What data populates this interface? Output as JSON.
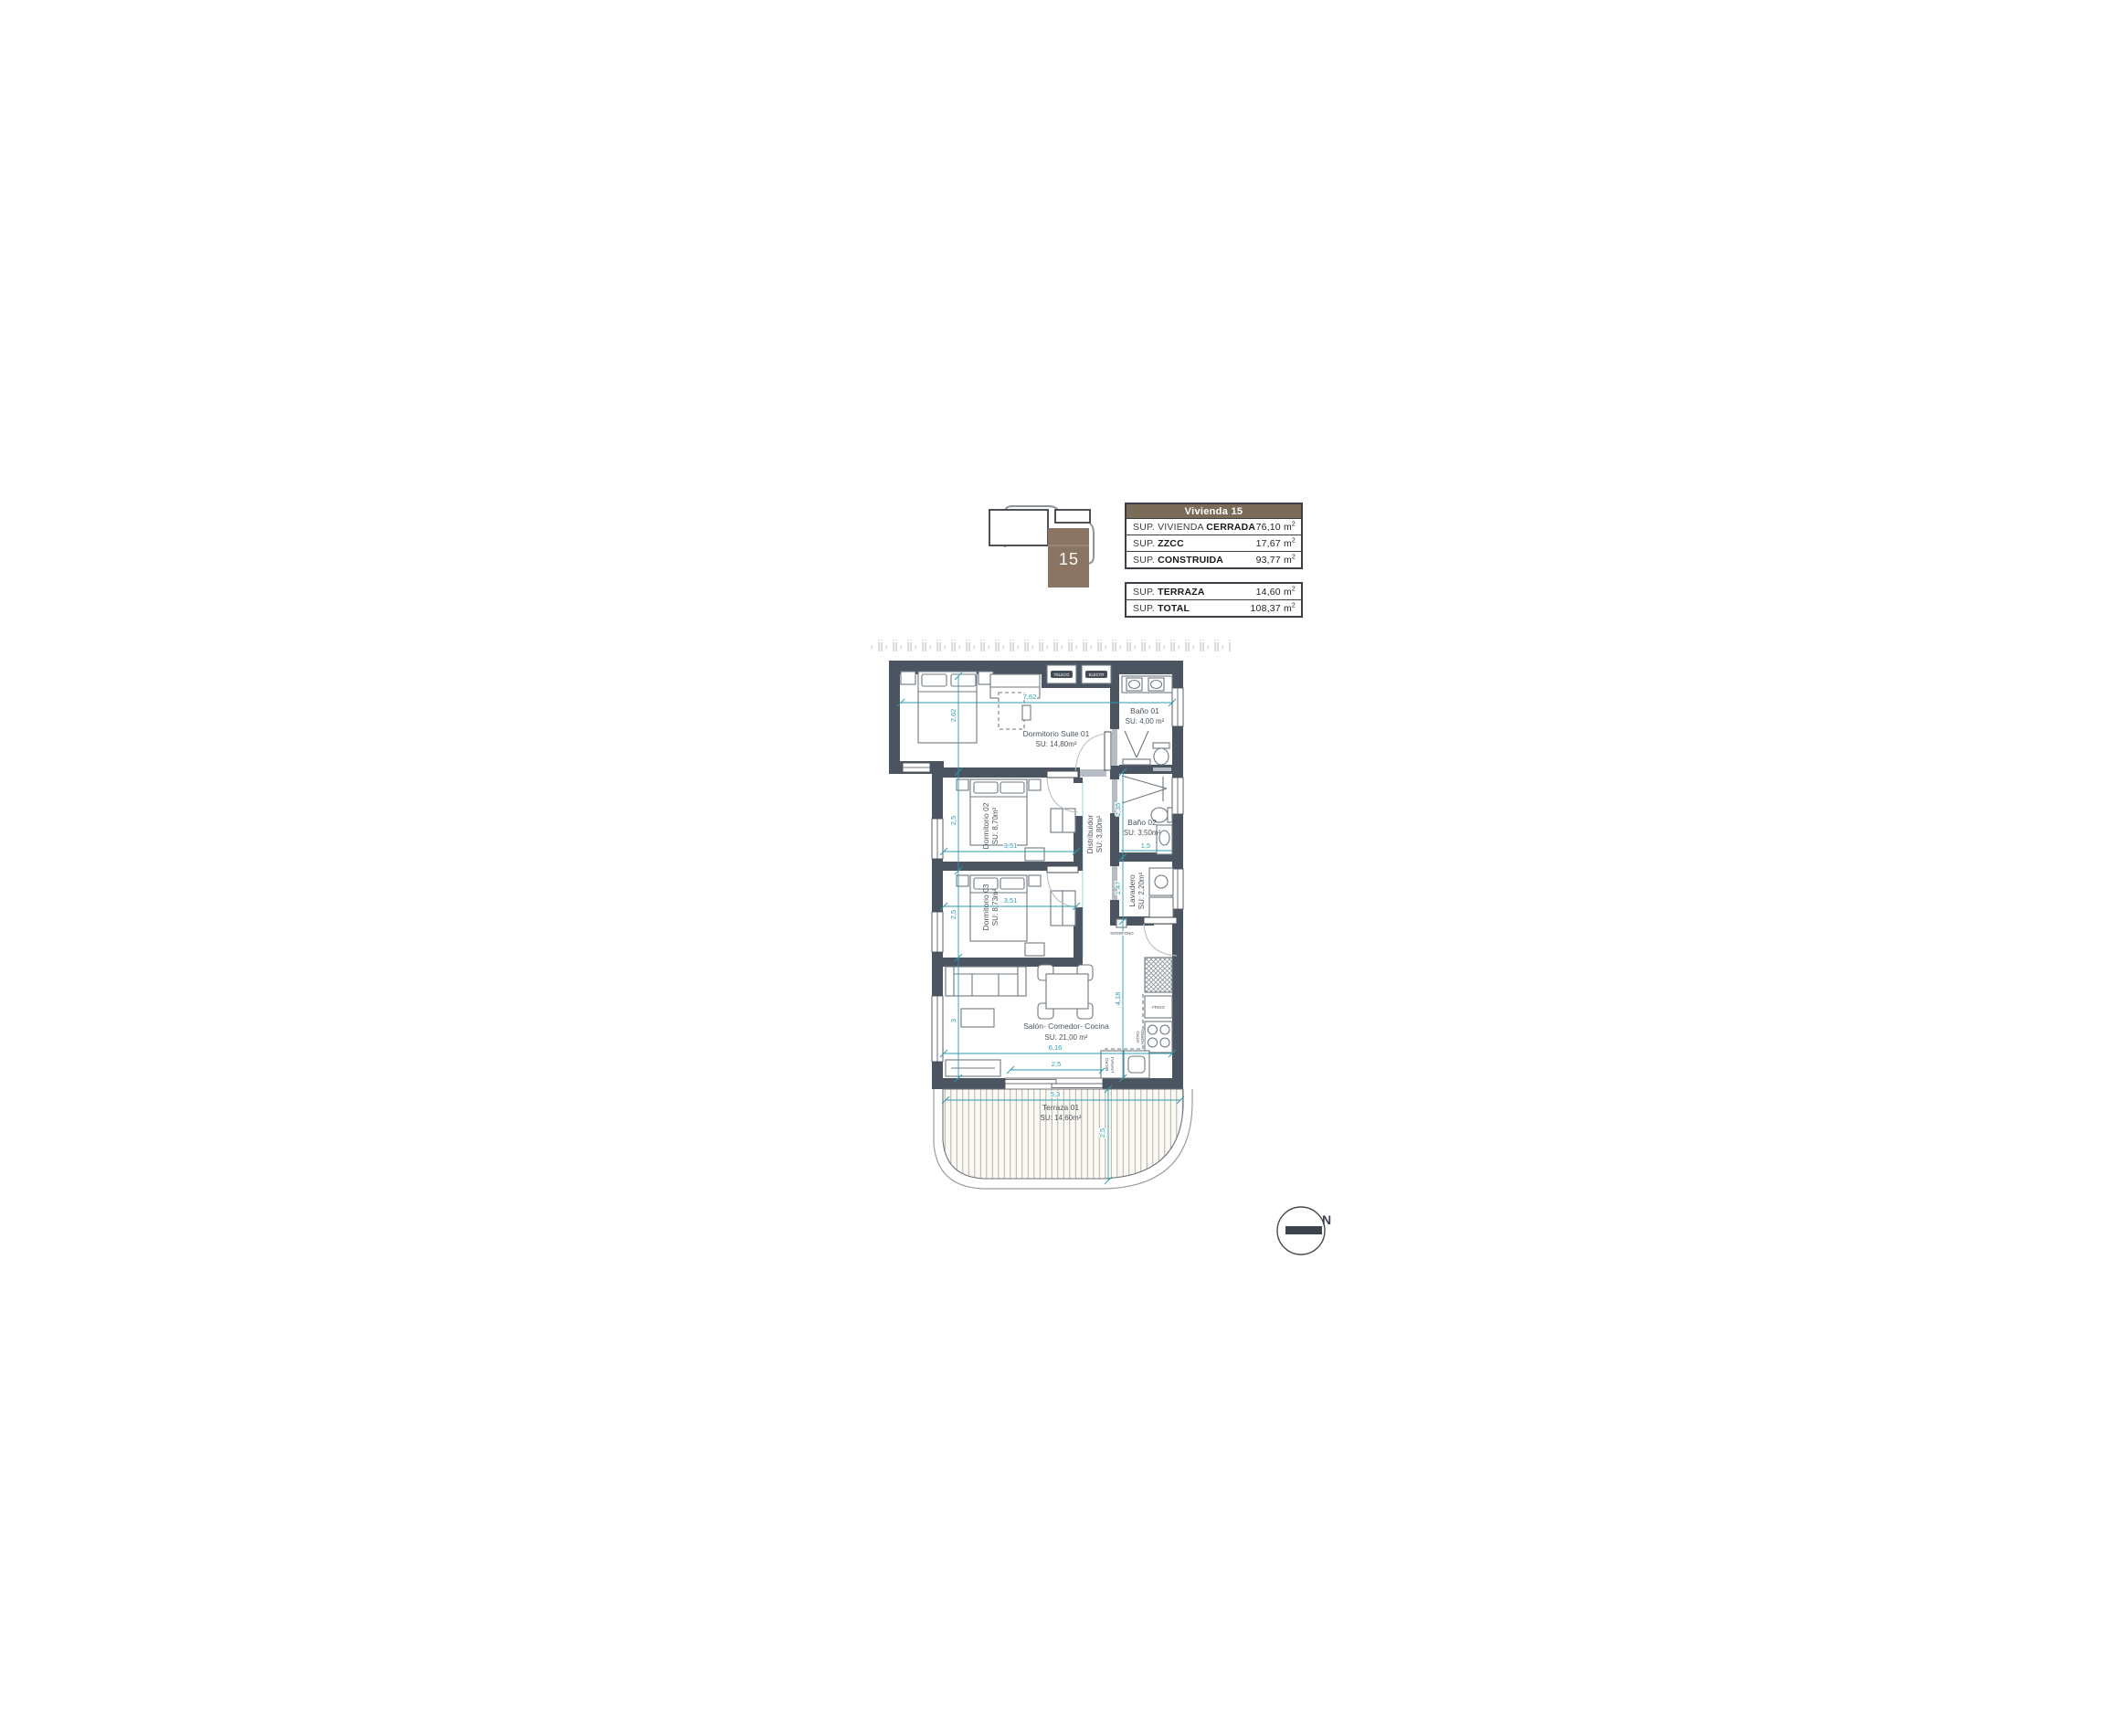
{
  "key_plan": {
    "unit_number": "15",
    "block_color": "#8a7464"
  },
  "summary_table": {
    "header": "Vivienda 15",
    "header_bg": "#7b6b59",
    "sections": [
      {
        "rows": [
          {
            "label": "SUP. VIVIENDA ",
            "label_bold": "CERRADA",
            "value": "76,10 m",
            "sup": "2"
          },
          {
            "label": "SUP. ",
            "label_bold": "ZZCC",
            "value": "17,67 m",
            "sup": "2"
          },
          {
            "label": "SUP. ",
            "label_bold": "CONSTRUIDA",
            "value": "93,77 m",
            "sup": "2"
          }
        ]
      },
      {
        "rows": [
          {
            "label": "SUP. ",
            "label_bold": "TERRAZA",
            "value": "14,60 m",
            "sup": "2"
          },
          {
            "label": "SUP. ",
            "label_bold": "TOTAL",
            "value": "108,37 m",
            "sup": "2"
          }
        ]
      }
    ]
  },
  "plan": {
    "rooms": [
      {
        "name": "Dormitorio Suite 01",
        "area": "SU: 14,80m²"
      },
      {
        "name": "Baño 01",
        "area": "SU: 4,00 m²"
      },
      {
        "name": "Dormitorio 02",
        "area": "SU: 8,70m²"
      },
      {
        "name": "Dormitorio 03",
        "area": "SU: 8,73m²"
      },
      {
        "name": "Distribuidor",
        "area": "SU: 3,80m²"
      },
      {
        "name": "Baño 02",
        "area": "SU: 3,50m²"
      },
      {
        "name": "Lavadero",
        "area": "SU: 2,20m²"
      },
      {
        "name": "Salón- Comedor- Cocina",
        "area": "SU: 21,00 m²"
      },
      {
        "name": "Terraza 01",
        "area": "SU: 14,60m²"
      }
    ],
    "dims": [
      "7,62",
      "2,62",
      "2,5",
      "3,51",
      "2,5",
      "3,51",
      "2,35",
      "1,5",
      "1,47",
      "4,18",
      "6,16",
      "2,5",
      "3",
      "5,3",
      "2,5"
    ],
    "fixtures": {
      "teleco": "TELECO",
      "electr": "ELECTR",
      "interfono": "INTERFONO",
      "frigo": "FRIGO",
      "vitro1": "VITRO",
      "vitro2": "HORNO",
      "micro1": "MICRO",
      "micro2": "LAVAVAJ."
    },
    "compass_north": "N",
    "colors": {
      "wall": "#4b5561",
      "dimension": "#2d9cad",
      "deck_line": "#b0aaa0",
      "label": "#4a545e"
    }
  }
}
